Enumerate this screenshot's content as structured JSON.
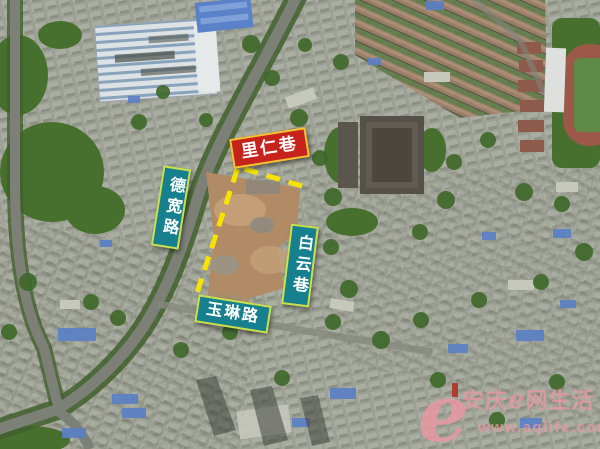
{
  "labels": {
    "liren_lane": "里仁巷",
    "dekuan_road": "德宽路",
    "baiyun_lane": "白云巷",
    "yulin_road": "玉琳路"
  },
  "watermark": {
    "logo_glyph": "e",
    "site_prefix": "安庆",
    "site_e": "e",
    "site_suffix": "网生活",
    "url": "www.aqlife.com"
  },
  "colors": {
    "label_red_bg": "#c5231c",
    "label_teal_bg": "#17808f",
    "label_border_yellow": "#cde04b",
    "boundary_yellow": "#f6e400",
    "watermark_pink": "#e798a1"
  }
}
